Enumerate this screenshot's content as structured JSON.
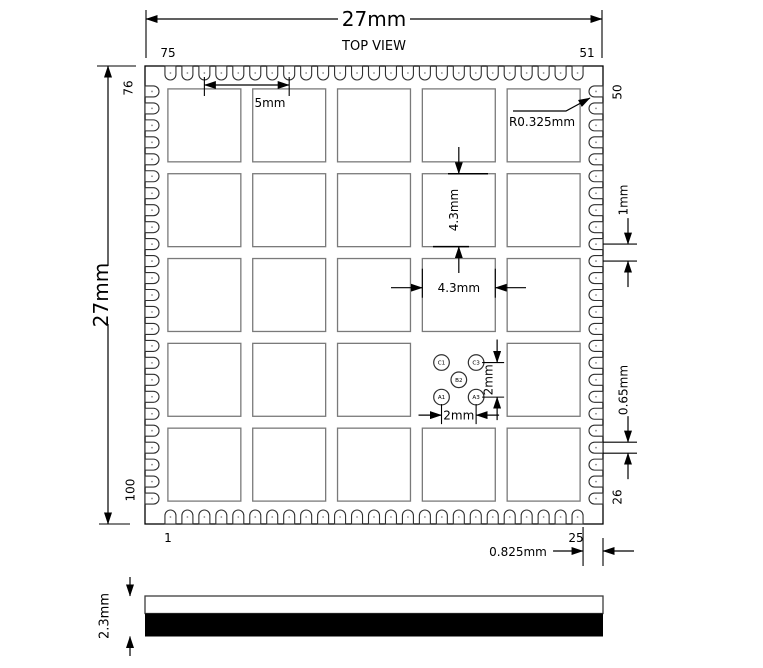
{
  "colors": {
    "line": "#000000",
    "grid_square": "#7a7a7a",
    "pad_outline": "#2f2f2f",
    "pad_dot": "#888888",
    "background": "#ffffff",
    "side_view_bottom_layer": "#000000"
  },
  "top_view": {
    "title": "TOP VIEW",
    "overall_width_label": "27mm",
    "overall_height_label": "27mm",
    "pin_labels": {
      "top_left": "75",
      "top_right": "51",
      "left_top": "76",
      "left_bottom": "100",
      "bottom_left": "1",
      "bottom_right": "25",
      "right_top": "50",
      "right_bottom": "26"
    },
    "pads": {
      "per_side": 25,
      "pitch_label": "1mm",
      "width_label": "0.65mm",
      "radius_label": "R0.325mm",
      "corner_offset_label": "0.825mm"
    },
    "grid": {
      "rows": 5,
      "cols": 5,
      "pitch_label": "5mm",
      "square_width_label": "4.3mm",
      "square_height_label": "4.3mm",
      "missing_cell": {
        "row": 3,
        "col": 3
      }
    },
    "fiducials": {
      "spacing_h_label": "2mm",
      "spacing_v_label": "2mm",
      "holes": [
        {
          "label": "C1",
          "col": 0,
          "row": 0
        },
        {
          "label": "C3",
          "col": 2,
          "row": 0
        },
        {
          "label": "B2",
          "col": 1,
          "row": 1
        },
        {
          "label": "A1",
          "col": 0,
          "row": 2
        },
        {
          "label": "A3",
          "col": 2,
          "row": 2
        }
      ]
    }
  },
  "side_view": {
    "thickness_label": "2.3mm"
  }
}
